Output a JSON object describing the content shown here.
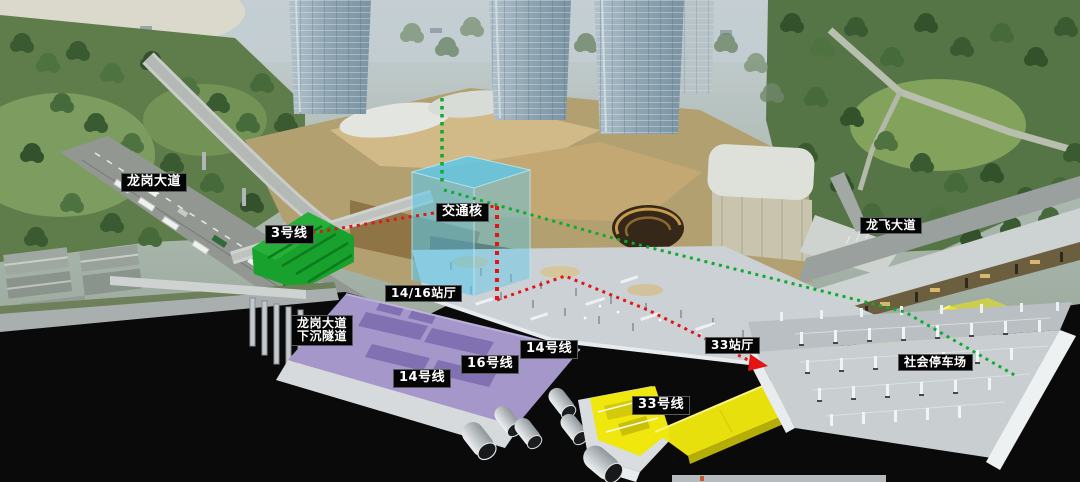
{
  "scene_title": "地铁枢纽剖视示意图",
  "annotations": {
    "longgang_avenue": "龙岗大道",
    "line3": "3号线",
    "transport_core": "交通核",
    "hall_14_16": "14/16站厅",
    "tunnel_line1": "龙岗大道",
    "tunnel_line2": "下沉隧道",
    "line14_left": "14号线",
    "line16": "16号线",
    "line14_right": "14号线",
    "hall_33": "33站厅",
    "line33": "33号线",
    "longfei_avenue": "龙飞大道",
    "public_parking": "社会停车场"
  },
  "colors": {
    "label_bg": "#050505",
    "label_text": "#ffffff",
    "line3_green": "#18a12c",
    "transport_core_cyan": "#5ec7e8",
    "line14_16_purple": "#a697cb",
    "line33_yellow": "#efe70d",
    "route_red": "#e41414",
    "route_green": "#0faa30"
  }
}
